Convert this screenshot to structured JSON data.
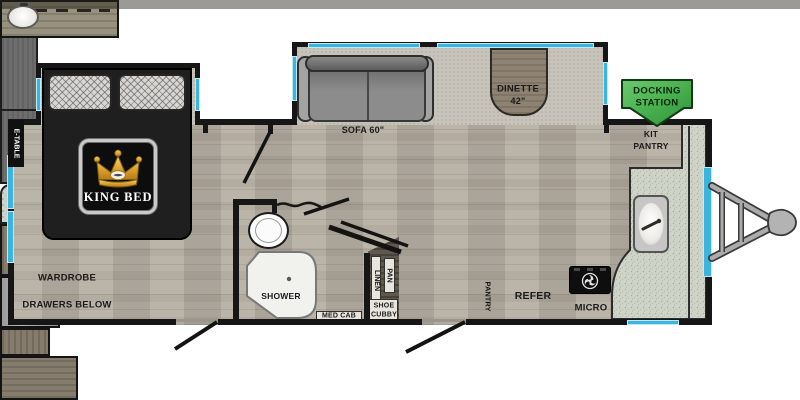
{
  "labels": {
    "e_table": "E-TABLE",
    "king_bed": "KING BED",
    "wardrobe": "WARDROBE",
    "drawers_below": "DRAWERS BELOW",
    "sofa": "SOFA 60\"",
    "dinette": "DINETTE",
    "dinette_size": "42\"",
    "shower": "SHOWER",
    "med_cab": "MED CAB",
    "linen": "LINEN",
    "pan": "PAN",
    "shoe": "SHOE",
    "cubby": "CUBBY",
    "pantry": "PANTRY",
    "refer": "REFER",
    "micro": "MICRO",
    "kit_pantry_1": "KIT",
    "kit_pantry_2": "PANTRY",
    "docking_1": "DOCKING",
    "docking_2": "STATION"
  },
  "colors": {
    "wall": "#161616",
    "window_accent": "#3ab5e0",
    "docking_green": "#46ae4c",
    "floor": "#b5aea3",
    "counter": "#cfd4c9",
    "crown_gold": "#e2a733",
    "bed": "#1f1f1f"
  },
  "icons": {
    "crown": "crown-icon",
    "stove_burner": "stove-burner-icon",
    "kitchen_faucet": "faucet-icon",
    "docking_arrow": "down-arrow-sign-icon",
    "hitch": "trailer-hitch"
  }
}
